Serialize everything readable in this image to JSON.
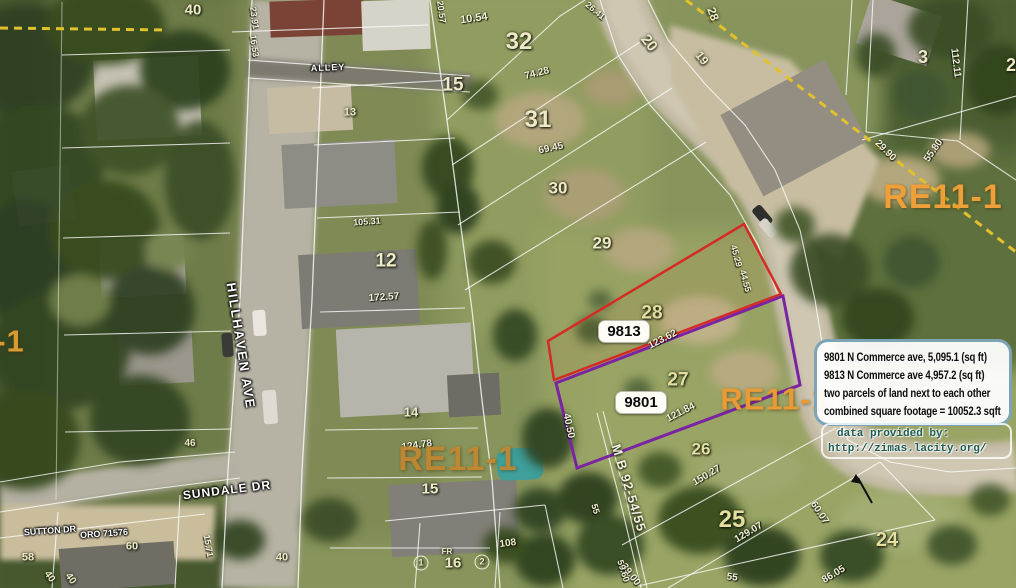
{
  "map": {
    "title": "ZIMAS aerial parcel map - 9801 / 9813 N Commerce Ave",
    "parcel_callouts": [
      {
        "text": "9813"
      },
      {
        "text": "9801"
      }
    ],
    "info_box": {
      "lines": [
        "9801 N Commerce ave, 5,095.1 (sq ft)",
        "9813 N Commerce ave 4,957.2 (sq ft)",
        "two parcels of land next to each other",
        "combined square footage = 10052.3 sqft"
      ],
      "border_color": "#7da4b5"
    },
    "credit": {
      "line1": "data provided by:",
      "line2": "http://zimas.lacity.org/",
      "text_color": "#1d5c55"
    },
    "zoning_labels": [
      {
        "text": "RE11-1"
      },
      {
        "text": "RE11-1"
      },
      {
        "text": "RE11-1"
      },
      {
        "text": "-1"
      }
    ],
    "streets": [
      {
        "name": "HILLHAVEN AVE"
      },
      {
        "name": "SUNDALE DR"
      },
      {
        "name": "SUTTON DR"
      },
      {
        "name": "ORO 71576"
      },
      {
        "name": "ALLEY"
      }
    ],
    "lot_numbers": [
      {
        "text": "40"
      },
      {
        "text": "32"
      },
      {
        "text": "31"
      },
      {
        "text": "15"
      },
      {
        "text": "30"
      },
      {
        "text": "29"
      },
      {
        "text": "28"
      },
      {
        "text": "27"
      },
      {
        "text": "26"
      },
      {
        "text": "25"
      },
      {
        "text": "24"
      },
      {
        "text": "12"
      },
      {
        "text": "14"
      },
      {
        "text": "15"
      },
      {
        "text": "13"
      },
      {
        "text": "46"
      },
      {
        "text": "3"
      },
      {
        "text": "2"
      },
      {
        "text": "20"
      },
      {
        "text": "19"
      },
      {
        "text": "28"
      },
      {
        "text": "60"
      },
      {
        "text": "58"
      },
      {
        "text": "16"
      },
      {
        "text": "40"
      },
      {
        "text": "40"
      },
      {
        "text": "40"
      },
      {
        "text": "1"
      },
      {
        "text": "2"
      },
      {
        "text": "FR"
      },
      {
        "text": "108"
      }
    ],
    "dimensions": [
      {
        "text": "10.54"
      },
      {
        "text": "20.57"
      },
      {
        "text": "23.91"
      },
      {
        "text": "16.53"
      },
      {
        "text": "74.28"
      },
      {
        "text": "69.45"
      },
      {
        "text": "105.31"
      },
      {
        "text": "172.57"
      },
      {
        "text": "123.62"
      },
      {
        "text": "121.84"
      },
      {
        "text": "40.50"
      },
      {
        "text": "124.78"
      },
      {
        "text": "150.27"
      },
      {
        "text": "129.07"
      },
      {
        "text": "60.07"
      },
      {
        "text": "86.05"
      },
      {
        "text": "39.00"
      },
      {
        "text": "55"
      },
      {
        "text": "45.29"
      },
      {
        "text": "44.55"
      },
      {
        "text": "29.90"
      },
      {
        "text": "55.80"
      },
      {
        "text": "112.11"
      },
      {
        "text": "26.41"
      },
      {
        "text": "15.71"
      },
      {
        "text": "59.60"
      },
      {
        "text": "55"
      },
      {
        "text": "M B 92-54/55"
      }
    ],
    "colors": {
      "parcel_9813_outline": "#d42b25",
      "parcel_9801_outline": "#7b24a2",
      "zoning_boundary_dashed": "#e2c22c",
      "zoning_text": "#ef9f38",
      "lot_line": "#ffffff"
    }
  }
}
